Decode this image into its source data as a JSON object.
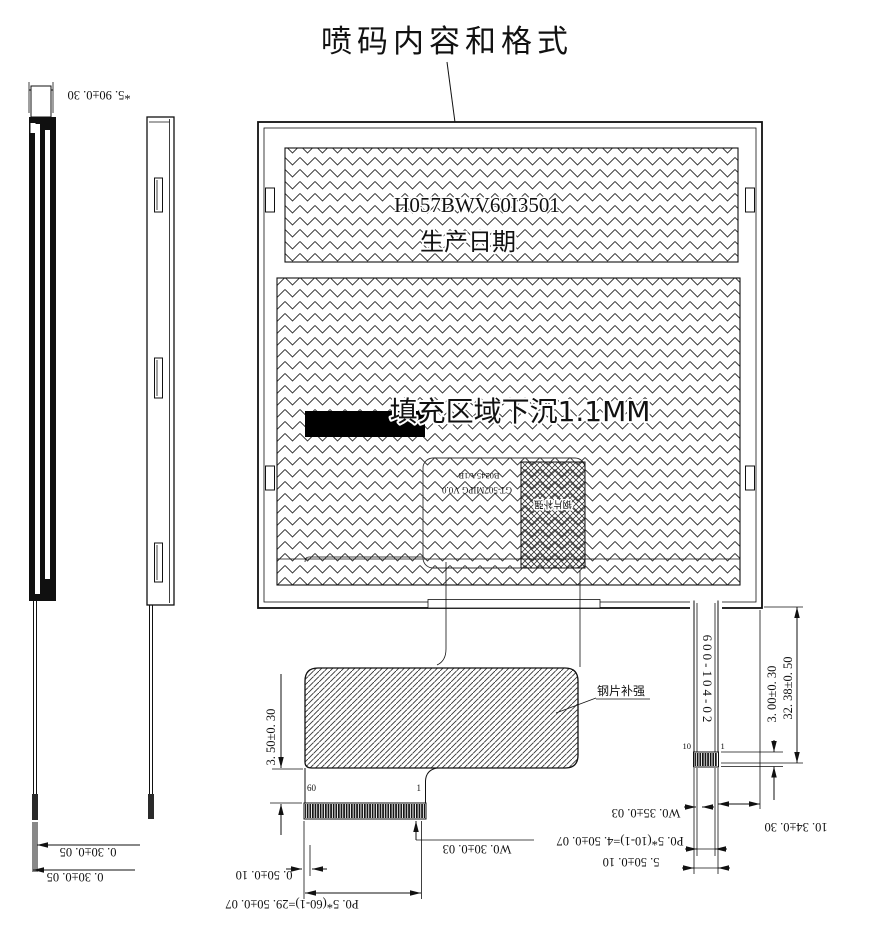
{
  "drawing": {
    "title": "喷码内容和格式",
    "panel": {
      "part_number": "H057BWV60I3501",
      "production_date_label": "生产日期",
      "fill_note": "填充区域下沉1.1MM",
      "back_print_line1": "B0245A/1B",
      "back_print_line2": "GT-507MIPG V0.0",
      "back_patch_label": "钢片补强"
    },
    "fpc": {
      "stiffener_label": "钢片补强",
      "pin_count_left": "60",
      "pin_count_right": "1",
      "tail_part_number": "600-104-02",
      "tail_pin_left": "10",
      "tail_pin_right": "1"
    },
    "dimensions": {
      "panel_thickness": "*5. 90±0. 30",
      "film_thickness_top": "0. 30±0. 05",
      "film_thickness_bottom": "0. 30±0. 05",
      "fpc_neck_height": "3. 50±0. 30",
      "pin_margin": "0. 50±0. 10",
      "pin_pitch_main": "P0. 5*(60-1)=29. 50±0. 07",
      "pin_width_main": "W0. 30±0. 03",
      "pin_width_tail": "W0. 35±0. 03",
      "pin_pitch_tail": "P0. 5*(10-1)=4. 50±0. 07",
      "tail_width": "5. 50±0. 10",
      "tail_offset": "10. 34±0. 30",
      "contact_height": "3. 00±0. 30",
      "tail_length": "32. 38±0. 50"
    },
    "colors": {
      "line": "#111111",
      "background": "#ffffff",
      "solid_fill": "#000000"
    }
  }
}
